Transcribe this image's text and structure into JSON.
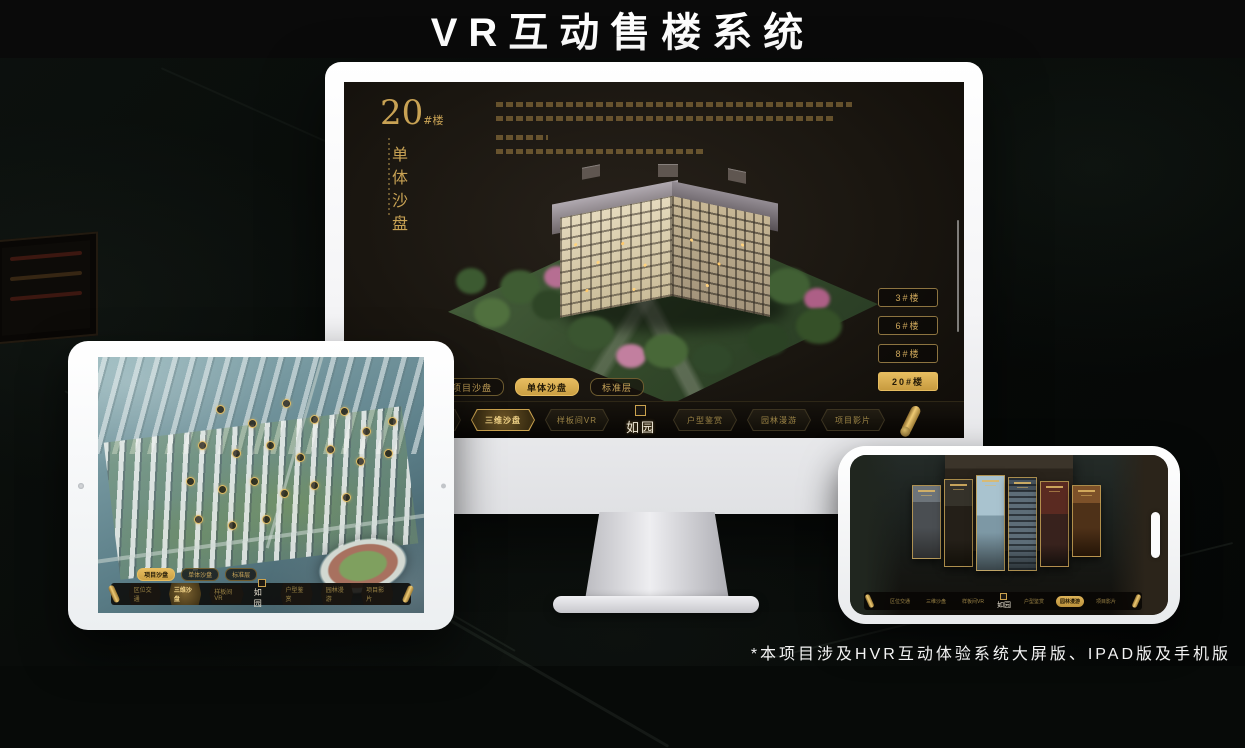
{
  "page": {
    "title": "VR互动售楼系统",
    "footnote": "*本项目涉及HVR互动体验系统大屏版、IPAD版及手机版"
  },
  "colors": {
    "gold": "#caa24e",
    "gold_bright": "#e7bd60",
    "screen_bg": "#1a150f",
    "background": "#070a08"
  },
  "desktop": {
    "heading": {
      "number": "20",
      "unit": "#楼",
      "subtitle": "单体沙盘"
    },
    "floor_buttons": [
      {
        "label": "3#楼",
        "active": false
      },
      {
        "label": "6#楼",
        "active": false
      },
      {
        "label": "8#楼",
        "active": false
      },
      {
        "label": "20#楼",
        "active": true
      }
    ],
    "sub_tabs": [
      {
        "label": "项目沙盘",
        "active": false
      },
      {
        "label": "单体沙盘",
        "active": true
      },
      {
        "label": "标准层",
        "active": false
      }
    ],
    "nav_items": [
      {
        "label": "区位交通",
        "active": false
      },
      {
        "label": "三维沙盘",
        "active": true
      },
      {
        "label": "样板间VR",
        "active": false
      },
      {
        "label": "户型鉴赏",
        "active": false
      },
      {
        "label": "园林漫游",
        "active": false
      },
      {
        "label": "项目影片",
        "active": false
      }
    ],
    "logo": "如园"
  },
  "tablet": {
    "sub_tabs": [
      {
        "label": "项目沙盘",
        "active": true
      },
      {
        "label": "单体沙盘",
        "active": false
      },
      {
        "label": "标准层",
        "active": false
      }
    ],
    "nav_items": [
      {
        "label": "区位交通",
        "active": false
      },
      {
        "label": "三维沙盘",
        "active": true
      },
      {
        "label": "样板间VR",
        "active": false
      },
      {
        "label": "户型鉴赏",
        "active": false
      },
      {
        "label": "园林漫游",
        "active": false
      },
      {
        "label": "项目影片",
        "active": false
      }
    ],
    "logo": "如园"
  },
  "phone": {
    "nav_items": [
      {
        "label": "区位交通",
        "active": false
      },
      {
        "label": "三维沙盘",
        "active": false
      },
      {
        "label": "样板间VR",
        "active": false
      },
      {
        "label": "户型鉴赏",
        "active": false
      },
      {
        "label": "园林漫游",
        "active": true
      },
      {
        "label": "项目影片",
        "active": false
      }
    ],
    "logo": "如园"
  }
}
